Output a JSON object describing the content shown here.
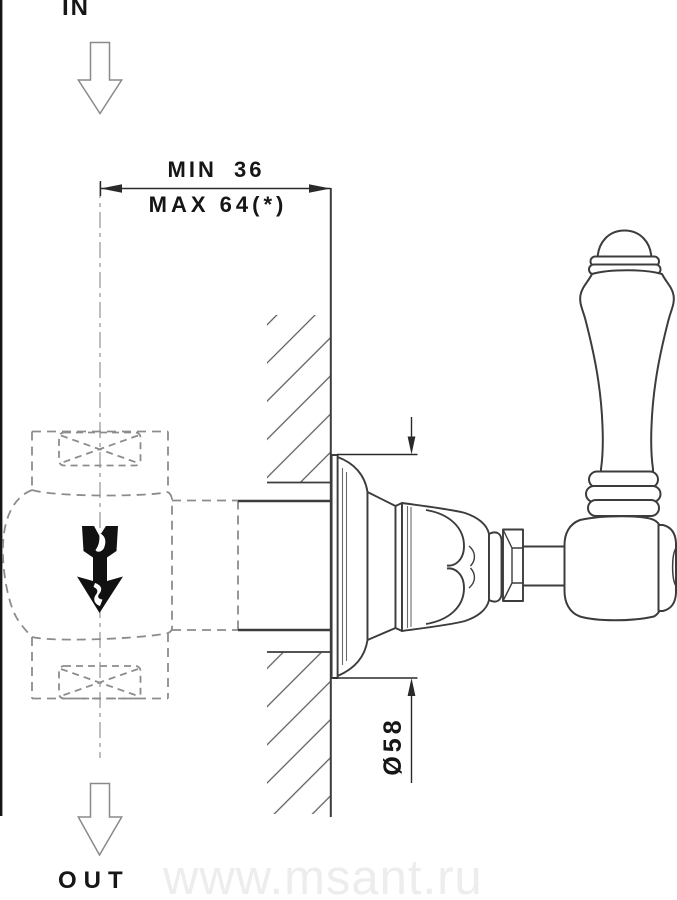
{
  "drawing": {
    "type": "technical-installation-diagram",
    "labels": {
      "inlet": "IN",
      "outlet": "OUT",
      "dim_depth_min": "MIN 36",
      "dim_depth_max": "MAX 64(*)",
      "dim_diameter": "Ø58",
      "watermark": "www.msant.ru"
    },
    "colors": {
      "solid_line": "#3c3c3c",
      "hidden_line": "#8c8c8c",
      "centerline": "#a2a2a2",
      "hatch": "#5a5a5a",
      "flow_arrow": "#111111",
      "flow_arrow_hint": "#888888",
      "border": "#161616",
      "watermark": "#ededed",
      "background": "#ffffff"
    }
  }
}
